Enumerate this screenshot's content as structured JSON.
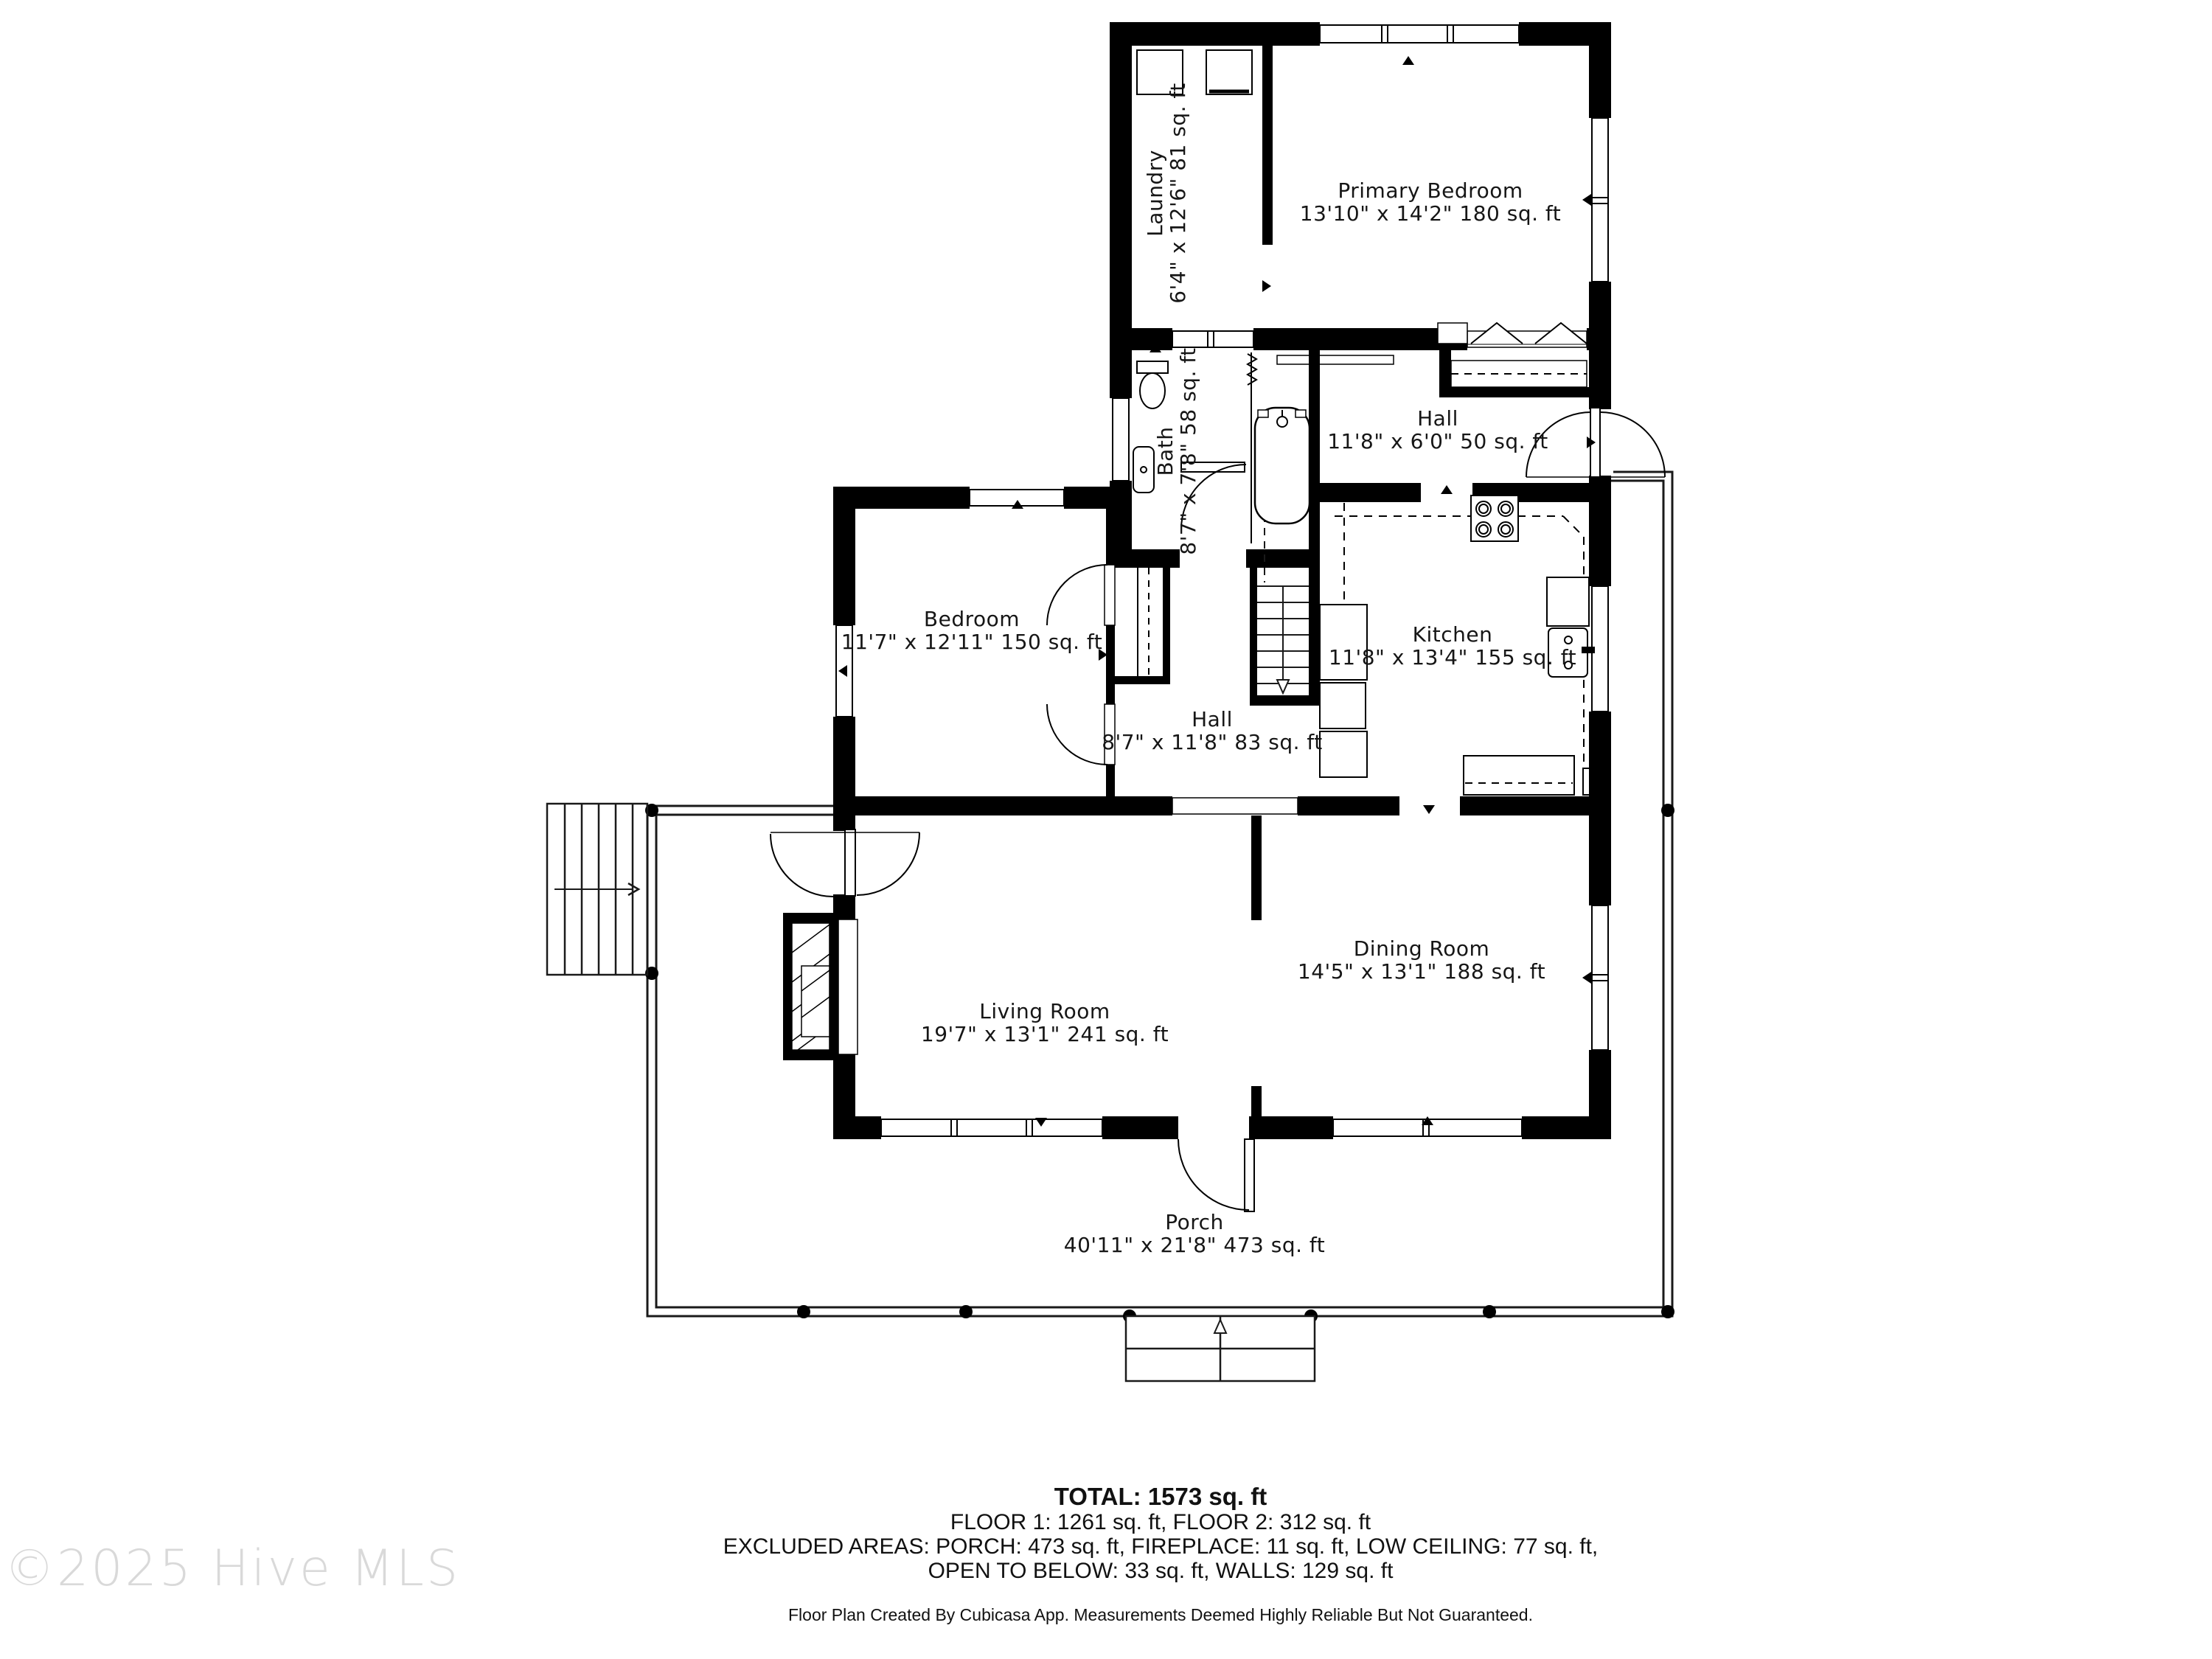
{
  "watermark": "©2025 Hive MLS",
  "rooms": {
    "laundry": {
      "name": "Laundry",
      "dims": "6'4\" x 12'6\" 81 sq. ft"
    },
    "primary_bedroom": {
      "name": "Primary Bedroom",
      "dims": "13'10\" x 14'2\" 180 sq. ft"
    },
    "bath": {
      "name": "Bath",
      "dims": "8'7\" x 7'8\" 58 sq. ft"
    },
    "hall_upper": {
      "name": "Hall",
      "dims": "11'8\" x 6'0\" 50 sq. ft"
    },
    "bedroom": {
      "name": "Bedroom",
      "dims": "11'7\" x 12'11\" 150 sq. ft"
    },
    "kitchen": {
      "name": "Kitchen",
      "dims": "11'8\" x 13'4\" 155 sq. ft"
    },
    "hall_middle": {
      "name": "Hall",
      "dims": "8'7\" x 11'8\" 83 sq. ft"
    },
    "living_room": {
      "name": "Living Room",
      "dims": "19'7\" x 13'1\" 241 sq. ft"
    },
    "dining_room": {
      "name": "Dining Room",
      "dims": "14'5\" x 13'1\" 188 sq. ft"
    },
    "porch": {
      "name": "Porch",
      "dims": "40'11\" x 21'8\" 473 sq. ft"
    }
  },
  "summary": {
    "total": "TOTAL: 1573 sq. ft",
    "floors": "FLOOR 1: 1261 sq. ft, FLOOR 2: 312 sq. ft",
    "excluded1": "EXCLUDED AREAS: PORCH: 473 sq. ft, FIREPLACE: 11 sq. ft, LOW CEILING: 77 sq. ft,",
    "excluded2": "OPEN TO BELOW: 33 sq. ft, WALLS: 129 sq. ft",
    "footer": "Floor Plan Created By Cubicasa App. Measurements Deemed Highly Reliable But Not Guaranteed."
  }
}
